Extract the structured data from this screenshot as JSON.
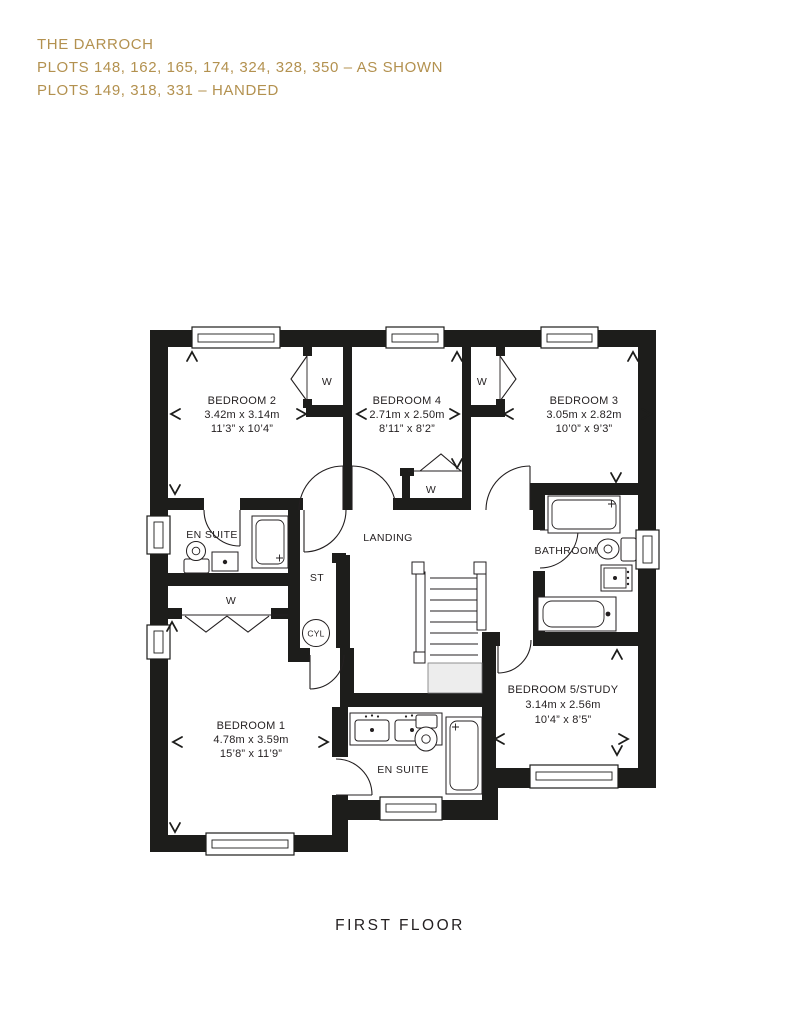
{
  "header": {
    "title": "THE DARROCH",
    "plots_as_shown": "PLOTS 148, 162, 165, 174, 324, 328, 350 – AS SHOWN",
    "plots_handed": "PLOTS 149, 318, 331 – HANDED"
  },
  "floor_label": "FIRST FLOOR",
  "colors": {
    "accent_gold": "#b3914f",
    "line_black": "#231f20"
  },
  "labels": {
    "bedroom2": {
      "name": "BEDROOM 2",
      "metric": "3.42m x 3.14m",
      "imperial": "11’3” x 10’4”"
    },
    "bedroom4": {
      "name": "BEDROOM 4",
      "metric": "2.71m x 2.50m",
      "imperial": "8’11” x 8’2”"
    },
    "bedroom3": {
      "name": "BEDROOM 3",
      "metric": "3.05m x 2.82m",
      "imperial": "10’0” x 9’3”"
    },
    "bedroom1": {
      "name": "BEDROOM 1",
      "metric": "4.78m x 3.59m",
      "imperial": "15’8” x 11’9”"
    },
    "bedroom5": {
      "name": "BEDROOM 5/STUDY",
      "metric": "3.14m x 2.56m",
      "imperial": "10’4” x 8’5”"
    },
    "ensuite1": "EN SUITE",
    "ensuite2": "EN SUITE",
    "bathroom": "BATHROOM",
    "landing": "LANDING",
    "store": "ST",
    "cylinder": "CYL",
    "wardrobe": "W"
  }
}
